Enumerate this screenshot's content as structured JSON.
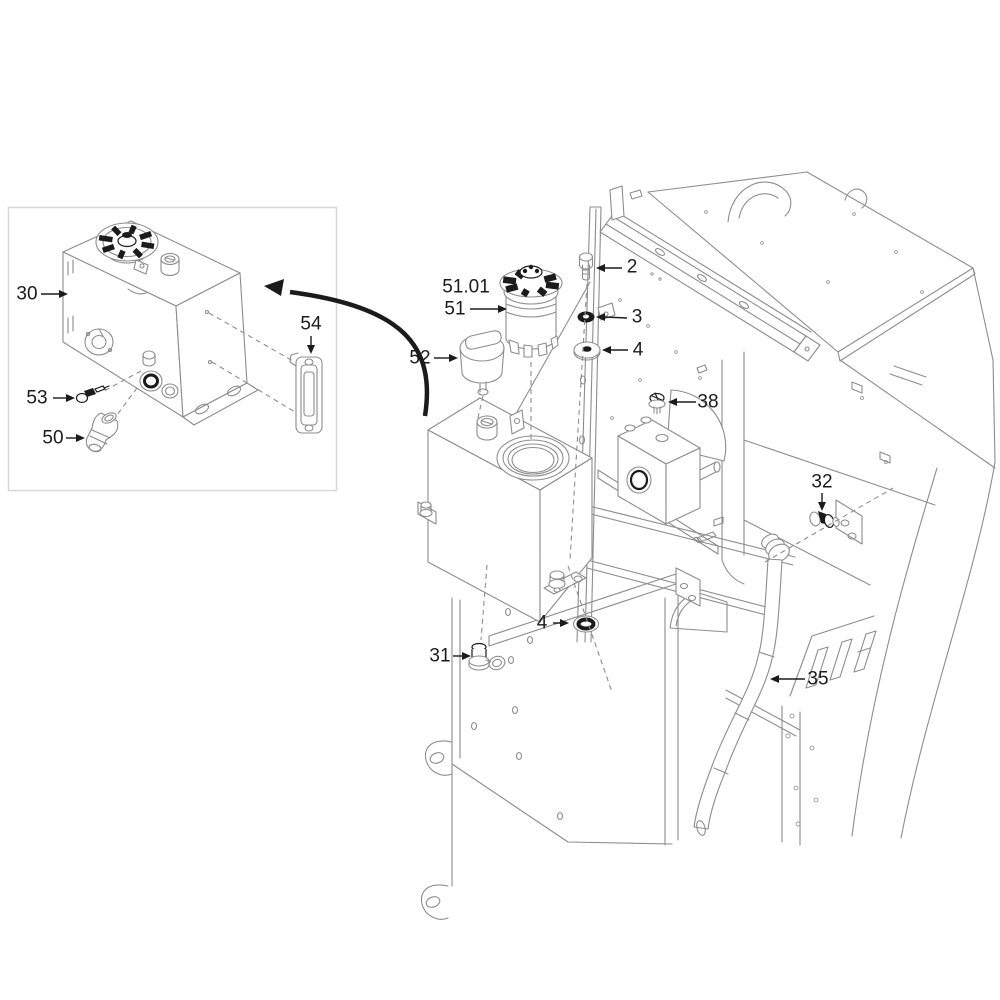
{
  "diagram": {
    "background": "#ffffff",
    "line_color": "#8d8d8d",
    "accent_color": "#1b1b1b",
    "inset_border_color": "#d8d8d8"
  },
  "callouts": {
    "c30": {
      "text": "30"
    },
    "c54": {
      "text": "54"
    },
    "c53": {
      "text": "53"
    },
    "c50": {
      "text": "50"
    },
    "c51_01": {
      "text": "51.01"
    },
    "c51": {
      "text": "51"
    },
    "c52": {
      "text": "52"
    },
    "c2": {
      "text": "2"
    },
    "c3": {
      "text": "3"
    },
    "c4a": {
      "text": "4"
    },
    "c38": {
      "text": "38"
    },
    "c32": {
      "text": "32"
    },
    "c31": {
      "text": "31"
    },
    "c4b": {
      "text": "4"
    },
    "c35": {
      "text": "35"
    }
  }
}
